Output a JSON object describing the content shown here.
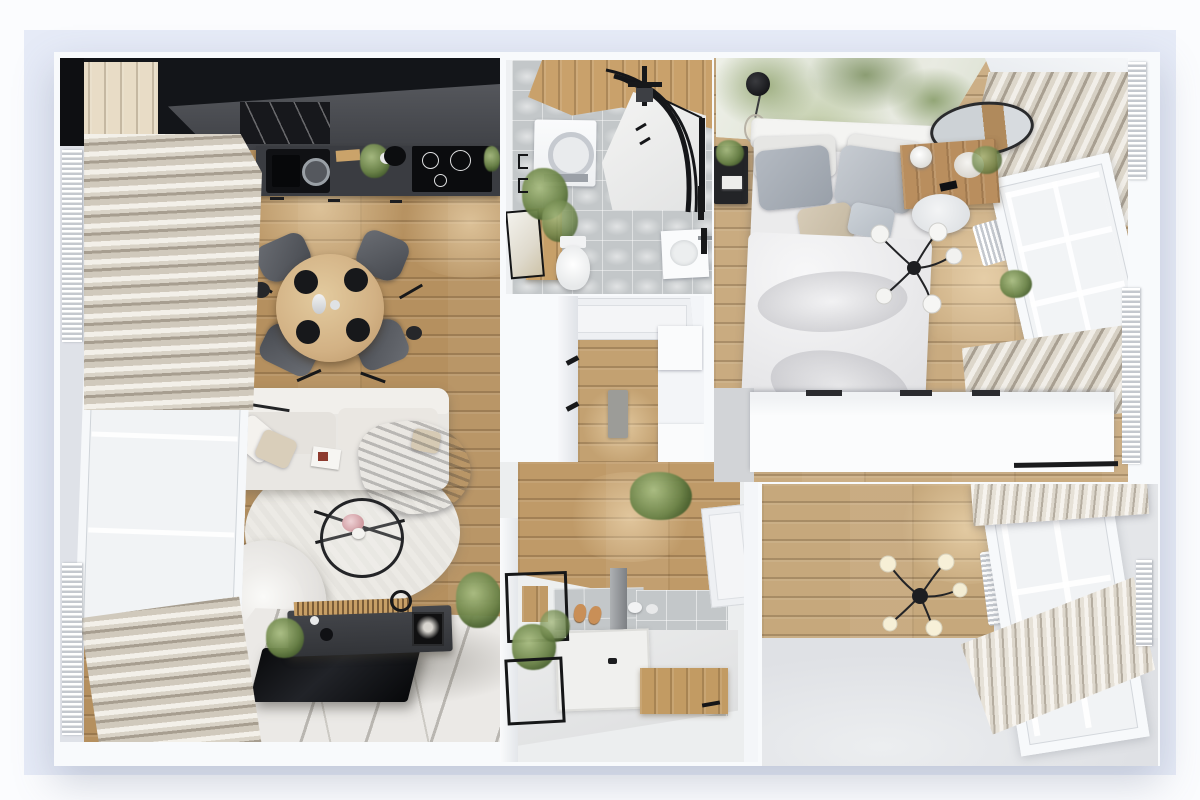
{
  "scene": {
    "title": "apartment-3d-floor-plan-top-view",
    "rooms": [
      {
        "name": "living-room-kitchen",
        "furniture": [
          "kitchen-cabinets",
          "countertop",
          "sink",
          "cooktop",
          "hood",
          "dining-table",
          "dining-chairs",
          "sofa",
          "pillows",
          "throw-blanket",
          "round-rug",
          "coffee-table",
          "armchair",
          "floor-lamp",
          "tv-console",
          "tv",
          "marble-floor",
          "curtains",
          "window",
          "radiators",
          "plants"
        ]
      },
      {
        "name": "bathroom",
        "furniture": [
          "wood-accent-wall",
          "washing-machine",
          "corner-shower",
          "shower-fixture",
          "toilet",
          "vanity",
          "sink",
          "framed-art",
          "plants"
        ]
      },
      {
        "name": "hallway",
        "furniture": [
          "entry-door",
          "runner-mat",
          "wardrobe-wall",
          "cabinets",
          "door-handles"
        ]
      },
      {
        "name": "bedroom",
        "furniture": [
          "botanical-mural",
          "double-bed",
          "pillows",
          "nightstand",
          "pendant-lamp",
          "spider-chandelier",
          "desk-vanity",
          "round-mirror",
          "chair",
          "wardrobe",
          "curtains",
          "window",
          "radiator",
          "plant"
        ]
      },
      {
        "name": "shower-room",
        "furniture": [
          "shower-tray",
          "shower-column",
          "bench",
          "slippers",
          "metal-shelf",
          "door",
          "plants",
          "tile-wall"
        ]
      },
      {
        "name": "empty-room",
        "furniture": [
          "spider-chandelier",
          "window",
          "radiator",
          "curtains"
        ]
      }
    ]
  },
  "palette": {
    "page_bg": "#fbfcfe",
    "mat": "#e6ebf7",
    "wall": "#f8fafc",
    "wood_living": "#b5905f",
    "wood_bedroom": "#c9ab80",
    "wood_corridor": "#c3a171",
    "wood_shower": "#bf9a68",
    "wood_accent": "#c9a16b",
    "tile": "#c3c7c9",
    "kitchen_black": "#131519",
    "counter_gray": "#3a3c41",
    "slab_gray": "#4b4d52",
    "sofa_white": "#e9e7e3",
    "chair_gray": "#5a5d63",
    "table_wood": "#d6ba8e",
    "rug_white": "#eceae5",
    "bed_white": "#ebebec",
    "wardrobe_white": "#fbfcfd",
    "mural_green": "#7f955f",
    "curtain_beige": "#d0c9bc",
    "floor_gray": "#e4e6e9"
  }
}
